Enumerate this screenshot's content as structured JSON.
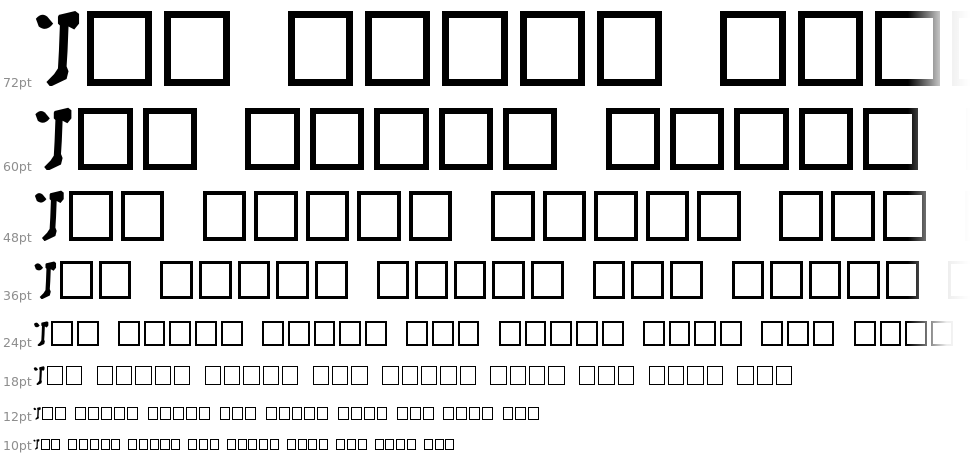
{
  "preview": {
    "text": "The quick brown fox jumps over the lazy dog",
    "rendered_letter": "T",
    "missing_glyph": "notdef-box"
  },
  "rows": [
    {
      "label": "72pt",
      "pt": 72
    },
    {
      "label": "60pt",
      "pt": 60
    },
    {
      "label": "48pt",
      "pt": 48
    },
    {
      "label": "36pt",
      "pt": 36
    },
    {
      "label": "24pt",
      "pt": 24
    },
    {
      "label": "18pt",
      "pt": 18
    },
    {
      "label": "12pt",
      "pt": 12
    },
    {
      "label": "10pt",
      "pt": 10
    }
  ],
  "colors": {
    "background": "#ffffff",
    "glyph": "#000000",
    "notdef_border": "#000000",
    "size_label": "#8e8e8e"
  }
}
